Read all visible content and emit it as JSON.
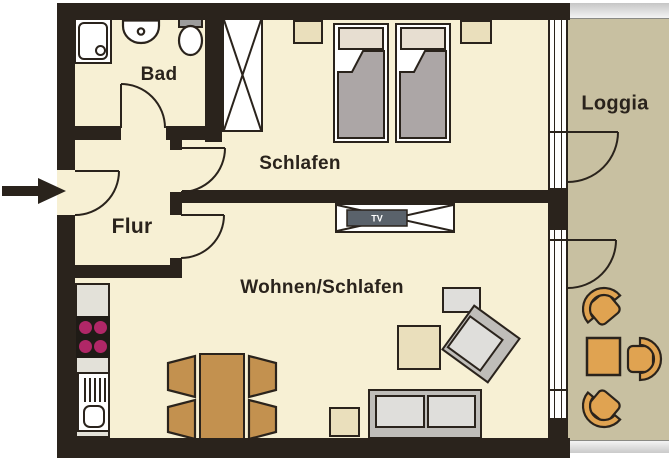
{
  "rooms": {
    "bad": {
      "label": "Bad"
    },
    "flur": {
      "label": "Flur"
    },
    "schlafen": {
      "label": "Schlafen"
    },
    "wohnen": {
      "label": "Wohnen/Schlafen"
    },
    "loggia": {
      "label": "Loggia"
    }
  },
  "tv": {
    "label": "TV"
  },
  "colors": {
    "wall": "#2A231C",
    "floor": "#F7F0D4",
    "loggia_floor": "#C8C0A1",
    "furniture_wood": "#C3914F",
    "loggia_furniture": "#E0A351",
    "blanket_gray": "#ACA6A6",
    "pillow": "#E7DED1",
    "beige_furniture": "#EADFBC",
    "cooktop_burner": "#B02767",
    "gray_furniture": "#DFDEDB",
    "gray_frame": "#BFBDB9",
    "tv_screen": "#5A626B",
    "counter": "#E3E1D9",
    "tank_gray": "#9C9C9C"
  }
}
